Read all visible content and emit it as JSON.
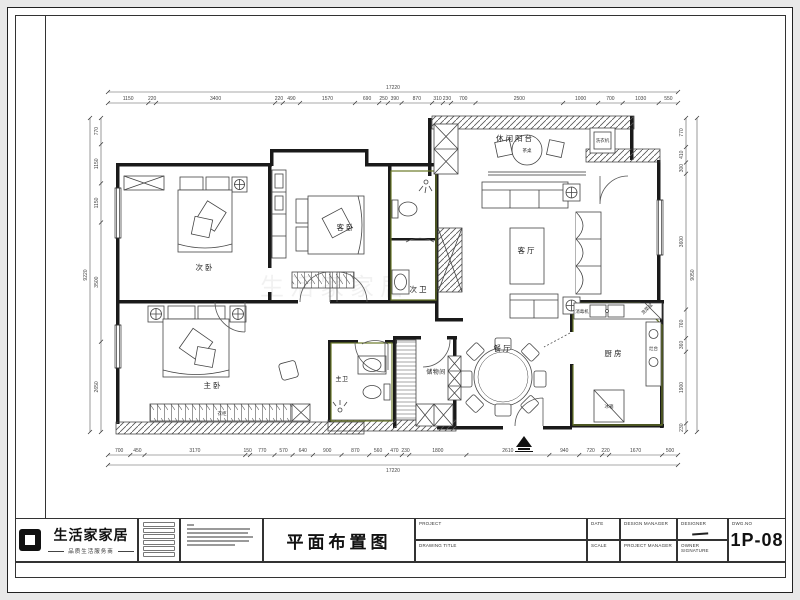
{
  "sheet": {
    "drawing_title": "平面布置图",
    "sheet_number": "1P-08",
    "logo": {
      "name": "生活家家居",
      "tagline": "品质生活服务商"
    },
    "fields": {
      "project": "PROJECT",
      "date": "DATE",
      "design_manager": "DESIGN MANAGER",
      "designer": "DESIGNER",
      "dwg_no": "DWG.NO",
      "drawing_title_label": "DRAWING TITLE",
      "scale": "SCALE",
      "project_manager": "PROJECT MANAGER",
      "owner_signature": "OWNER SIGNATURE"
    }
  },
  "rooms": {
    "secondary_bedroom": "次卧",
    "guest_bedroom": "客卧",
    "secondary_bath": "次卫",
    "leisure_balcony": "休闲阳台",
    "living_room": "客厅",
    "kitchen": "厨房",
    "dining_room": "餐厅",
    "storage_room": "储物间",
    "master_bath": "主卫",
    "master_bedroom": "主卧"
  },
  "furniture": {
    "tea_table": "茶桌",
    "washer": "洗衣机",
    "sterilizer": "消毒机",
    "sink": "洗菜盆",
    "stove": "灶台",
    "fridge": "冰箱",
    "wardrobe": "衣柜"
  },
  "dims": {
    "top": {
      "values": [
        1150,
        220,
        3400,
        220,
        490,
        1570,
        690,
        250,
        390,
        870,
        310,
        230,
        700,
        2500,
        1000,
        700,
        1030,
        550
      ],
      "total": "17220"
    },
    "bottom": {
      "values": [
        700,
        450,
        3170,
        150,
        770,
        570,
        640,
        900,
        870,
        560,
        470,
        230,
        1800,
        2610,
        940,
        720,
        220,
        1670,
        500
      ],
      "total": "17220"
    },
    "left": {
      "values": [
        770,
        1150,
        1150,
        3500,
        2650
      ],
      "total": "9220"
    },
    "right": {
      "values": [
        770,
        410,
        300,
        3600,
        760,
        360,
        1900,
        230
      ],
      "total": "9050"
    }
  },
  "colors": {
    "accent_green": "#6b7a28",
    "wall": "#1a1a1a"
  }
}
